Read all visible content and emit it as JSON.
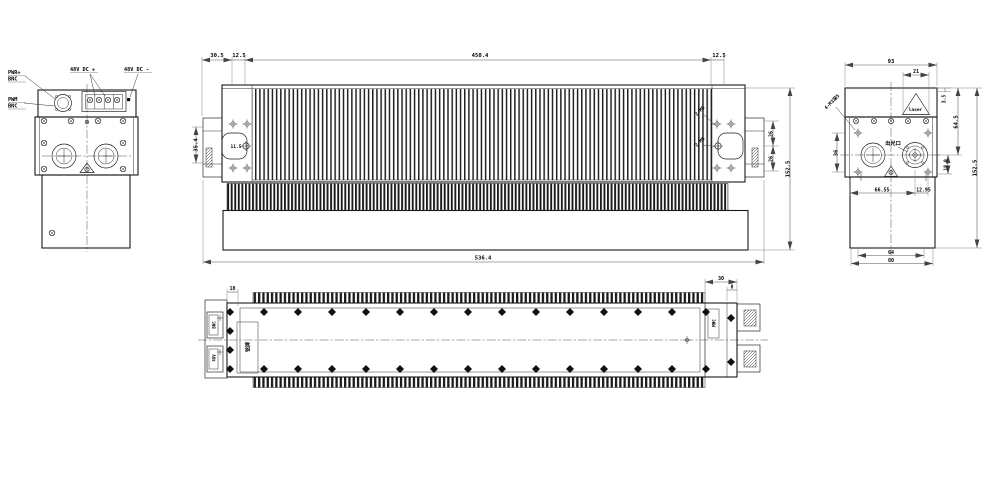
{
  "sheet": {
    "background": "#ffffff",
    "line_color": "#1a1a1a",
    "dim_color": "#555555"
  },
  "left_view": {
    "port_label_1_line1": "PWR+",
    "port_label_1_line2": "BNC",
    "port_label_2_line1": "PWM",
    "port_label_2_line2": "BNC",
    "dc_positive": "48V DC +",
    "dc_negative": "48V DC -"
  },
  "front_view": {
    "dim_30_5": "30.5",
    "dim_12_5_left": "12.5",
    "dim_450_4": "450.4",
    "dim_12_5_right": "12.5",
    "dim_35_4": "35.4",
    "dim_11_5": "11.5",
    "dim_26_upper": "26",
    "dim_26_lower": "26",
    "dim_152_5": "152.5",
    "dim_536_4": "536.4",
    "callout_upper": "2-M5",
    "callout_lower": "2-M5"
  },
  "right_view": {
    "dim_93": "93",
    "dim_21": "21",
    "dim_3_5": "3.5",
    "dim_64_5": "64.5",
    "dim_36": "36",
    "dim_18_9": "18.9",
    "dim_66_55": "66.55",
    "dim_12_95": "12.95",
    "dim_64": "64",
    "dim_80": "80",
    "dim_152_5": "152.5",
    "laser_mark": "laser",
    "light_port_label": "出光口",
    "hole_callout": "4-M3深5"
  },
  "plan_view": {
    "dim_10": "10",
    "dim_30": "30",
    "dim_8": "8",
    "nameplate_label": "铭牌",
    "connector_box_label": "MHC",
    "port_1_label": "BNC",
    "port_2_label": "48V"
  }
}
